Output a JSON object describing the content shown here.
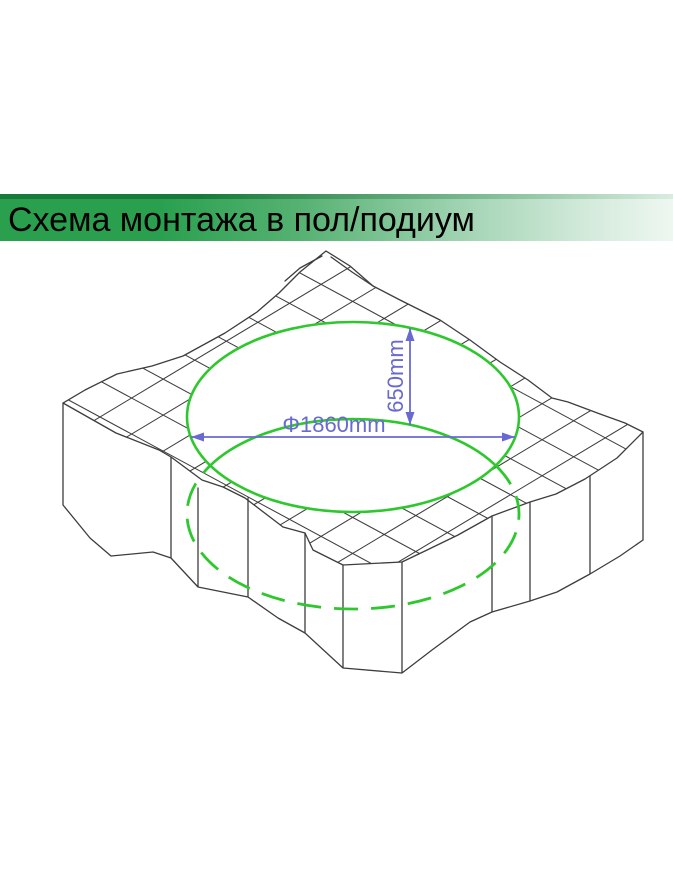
{
  "slide": {
    "title": "Схема монтажа в пол/подиум"
  },
  "diagram": {
    "description": "isometric-podium-cutout-installation-scheme",
    "dimensions": {
      "diameter_label": "Φ1860mm",
      "diameter_mm": 1860,
      "depth_label": "650mm",
      "depth_mm": 650
    }
  },
  "colors": {
    "banner_green": "#2aa04f",
    "banner_dark_strip": "#187a3a",
    "banner_fade": "#eef7f1",
    "outline": "#3d3d3d",
    "cutout_green": "#2ec82e",
    "dimension_blue": "#6969d2",
    "background": "#ffffff",
    "title_text": "#000000"
  }
}
